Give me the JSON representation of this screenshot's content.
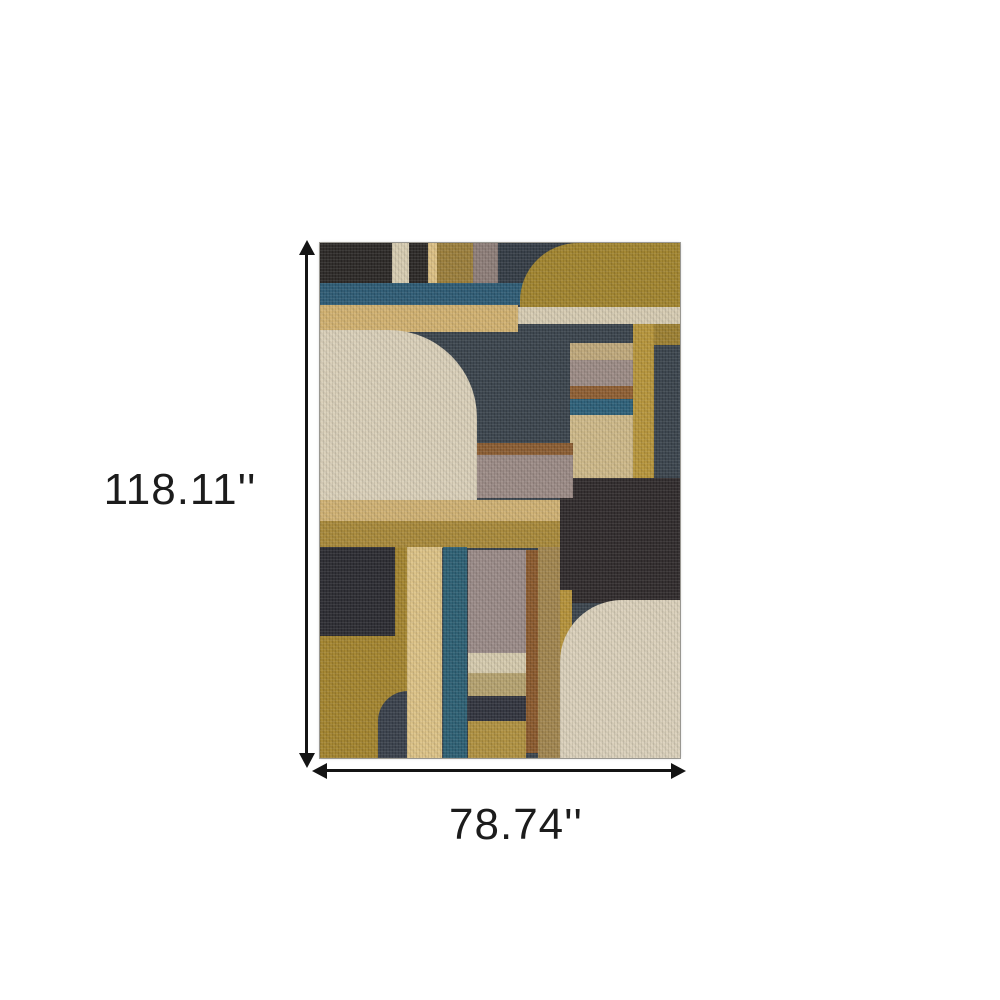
{
  "dimensions": {
    "height_label": "118.11''",
    "width_label": "78.74''"
  },
  "style": {
    "background": "#ffffff",
    "arrow_color": "#141414",
    "label_color": "#1c1c1c",
    "rug_border_color": "#5a554b"
  },
  "rug": {
    "base_color": "#3a434c",
    "blocks": [
      {
        "name": "top-left-dark-block",
        "x": 0,
        "y": 0,
        "w": 108,
        "h": 42,
        "c": "#2b2826"
      },
      {
        "name": "top-beige-stripe",
        "x": 72,
        "y": 0,
        "w": 17,
        "h": 42,
        "c": "#d7ccb1"
      },
      {
        "name": "top-tan-stripe",
        "x": 108,
        "y": 0,
        "w": 9,
        "h": 42,
        "c": "#dcc084"
      },
      {
        "name": "top-olive-block",
        "x": 117,
        "y": 0,
        "w": 36,
        "h": 42,
        "c": "#9b7e3b"
      },
      {
        "name": "top-mauve-block",
        "x": 153,
        "y": 0,
        "w": 25,
        "h": 42,
        "c": "#8d7d78"
      },
      {
        "name": "top-navy-block",
        "x": 178,
        "y": 0,
        "w": 80,
        "h": 42,
        "c": "#343c45"
      },
      {
        "name": "teal-band-top",
        "x": 0,
        "y": 40,
        "w": 206,
        "h": 22,
        "c": "#2d5b74"
      },
      {
        "name": "gold-rounded-top-right",
        "x": 200,
        "y": 0,
        "w": 160,
        "h": 66,
        "c": "#a1842e",
        "r": "58px 0 0 0"
      },
      {
        "name": "gold-band",
        "x": 0,
        "y": 62,
        "w": 198,
        "h": 27,
        "c": "#d1b170"
      },
      {
        "name": "beige-band-right",
        "x": 198,
        "y": 64,
        "w": 162,
        "h": 17,
        "c": "#d6cbb2"
      },
      {
        "name": "olive-patch-far-right",
        "x": 313,
        "y": 81,
        "w": 47,
        "h": 21,
        "c": "#9c7f31"
      },
      {
        "name": "gold-stripe-right",
        "x": 313,
        "y": 81,
        "w": 21,
        "h": 155,
        "c": "#b6953b"
      },
      {
        "name": "mid-tan-band",
        "x": 250,
        "y": 100,
        "w": 63,
        "h": 17,
        "c": "#bfa87b"
      },
      {
        "name": "mid-mauve-band",
        "x": 250,
        "y": 117,
        "w": 63,
        "h": 26,
        "c": "#9c8b85"
      },
      {
        "name": "mid-rust-band",
        "x": 250,
        "y": 143,
        "w": 63,
        "h": 13,
        "c": "#8e5e32"
      },
      {
        "name": "mid-teal-band",
        "x": 250,
        "y": 156,
        "w": 63,
        "h": 16,
        "c": "#2c5f78"
      },
      {
        "name": "mid-khaki-block",
        "x": 250,
        "y": 172,
        "w": 63,
        "h": 64,
        "c": "#cdb888"
      },
      {
        "name": "dark-brown-region-right",
        "x": 240,
        "y": 235,
        "w": 120,
        "h": 125,
        "c": "#2f2a2b"
      },
      {
        "name": "mid-brown-band",
        "x": 157,
        "y": 200,
        "w": 96,
        "h": 12,
        "c": "#8a5c31"
      },
      {
        "name": "mid-mauve-band-wide",
        "x": 157,
        "y": 212,
        "w": 96,
        "h": 43,
        "c": "#9b8a85"
      },
      {
        "name": "beige-rounded-left",
        "x": 0,
        "y": 87,
        "w": 157,
        "h": 170,
        "c": "#d9cfb8",
        "r": "0 88px 0 0"
      },
      {
        "name": "shelf-tan-band",
        "x": 0,
        "y": 257,
        "w": 240,
        "h": 21,
        "c": "#cfb173"
      },
      {
        "name": "shelf-gold-band",
        "x": 0,
        "y": 278,
        "w": 240,
        "h": 27,
        "c": "#a8893a"
      },
      {
        "name": "gold-region-bottom-left",
        "x": 0,
        "y": 304,
        "w": 87,
        "h": 211,
        "c": "#a3842e"
      },
      {
        "name": "navy-block-bottom-left",
        "x": 0,
        "y": 304,
        "w": 75,
        "h": 89,
        "c": "#2b2b31"
      },
      {
        "name": "dark-quarter-bottom",
        "x": 58,
        "y": 448,
        "w": 37,
        "h": 67,
        "c": "#39404b",
        "r": "30px 0 0 0"
      },
      {
        "name": "tan-stripe-vertical",
        "x": 87,
        "y": 304,
        "w": 35,
        "h": 211,
        "c": "#dcc286"
      },
      {
        "name": "teal-stripe-vertical",
        "x": 123,
        "y": 304,
        "w": 24,
        "h": 211,
        "c": "#2c5f73"
      },
      {
        "name": "mauve-block-bottom",
        "x": 148,
        "y": 307,
        "w": 58,
        "h": 103,
        "c": "#9a8a87"
      },
      {
        "name": "beige-band-bottom",
        "x": 148,
        "y": 410,
        "w": 58,
        "h": 20,
        "c": "#d5caad"
      },
      {
        "name": "khaki-band-bottom",
        "x": 148,
        "y": 430,
        "w": 58,
        "h": 23,
        "c": "#b5a26f"
      },
      {
        "name": "navy-band-bottom",
        "x": 148,
        "y": 453,
        "w": 58,
        "h": 25,
        "c": "#31343e"
      },
      {
        "name": "gold-band-bottom",
        "x": 148,
        "y": 478,
        "w": 58,
        "h": 37,
        "c": "#b09140"
      },
      {
        "name": "rust-stripe-bottom",
        "x": 206,
        "y": 307,
        "w": 12,
        "h": 203,
        "c": "#8a592c"
      },
      {
        "name": "khaki-stripe-bottom",
        "x": 218,
        "y": 304,
        "w": 22,
        "h": 211,
        "c": "#a1854e"
      },
      {
        "name": "gold-stripe-bottom-right",
        "x": 240,
        "y": 347,
        "w": 12,
        "h": 168,
        "c": "#b5923a"
      },
      {
        "name": "beige-rounded-bottom-right",
        "x": 240,
        "y": 357,
        "w": 120,
        "h": 158,
        "c": "#dad0ba",
        "r": "62px 0 0 0"
      }
    ]
  }
}
